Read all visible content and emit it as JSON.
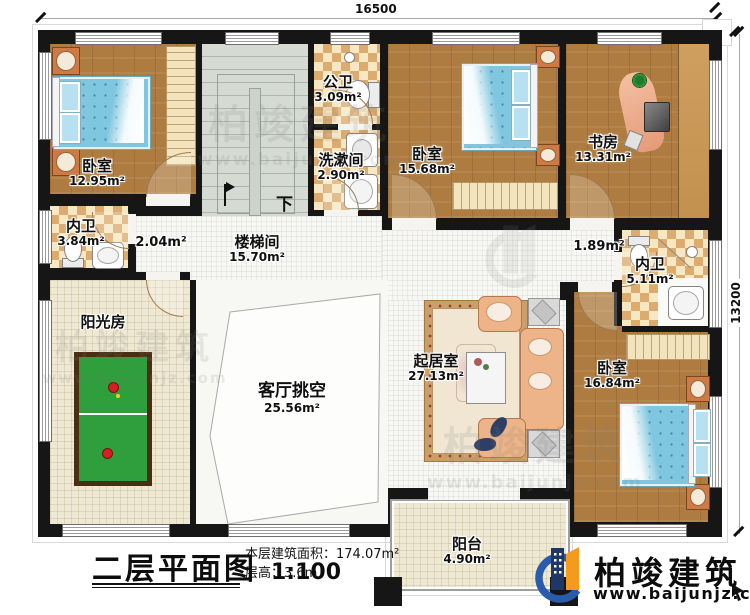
{
  "dimensions": {
    "top": "16500",
    "right": "13200"
  },
  "rooms": {
    "bedroom1": {
      "name": "卧室",
      "area": "12.95m²"
    },
    "stairwell": {
      "name": "楼梯间",
      "area": "15.70m²"
    },
    "public_bath": {
      "name": "公卫",
      "area": "3.09m²"
    },
    "washroom": {
      "name": "洗漱间",
      "area": "2.90m²"
    },
    "bedroom2": {
      "name": "卧室",
      "area": "15.68m²"
    },
    "study": {
      "name": "书房",
      "area": "13.31m²"
    },
    "ensuite_left": {
      "name": "内卫",
      "area": "3.84m²"
    },
    "hall_left": {
      "area": "2.04m²"
    },
    "hall_right": {
      "area": "1.89m²"
    },
    "ensuite_right": {
      "name": "内卫",
      "area": "5.11m²"
    },
    "sunroom": {
      "name": "阳光房"
    },
    "living_void": {
      "name": "客厅挑空",
      "area": "25.56m²"
    },
    "living": {
      "name": "起居室",
      "area": "27.13m²"
    },
    "bedroom3": {
      "name": "卧室",
      "area": "16.84m²"
    },
    "balcony": {
      "name": "阳台",
      "area": "4.90m²"
    }
  },
  "stair": {
    "direction_label": "下"
  },
  "titleblock": {
    "title": "二层平面图",
    "scale": "1:100",
    "floor_area": "本层建筑面积：174.07m²",
    "floor_height": "层高：3.6m"
  },
  "brand": {
    "name": "柏竣建筑",
    "website": "www.baijunjz.com"
  },
  "watermark": {
    "name": "柏竣建筑",
    "website": "www.baijunjz.com"
  },
  "colors": {
    "wall": "#161616",
    "wood_floor": "#ae7c40",
    "tile_light": "#f7e7c2",
    "tile_dark": "#dcab6d",
    "stair": "#d5dad3",
    "bed": "#7fc6df",
    "table_tennis_green": "#2f9e3c",
    "sofa": "#ecb488",
    "brand_navy": "#1d3766",
    "brand_orange": "#f49a1d",
    "brand_blue": "#2b5cab"
  }
}
